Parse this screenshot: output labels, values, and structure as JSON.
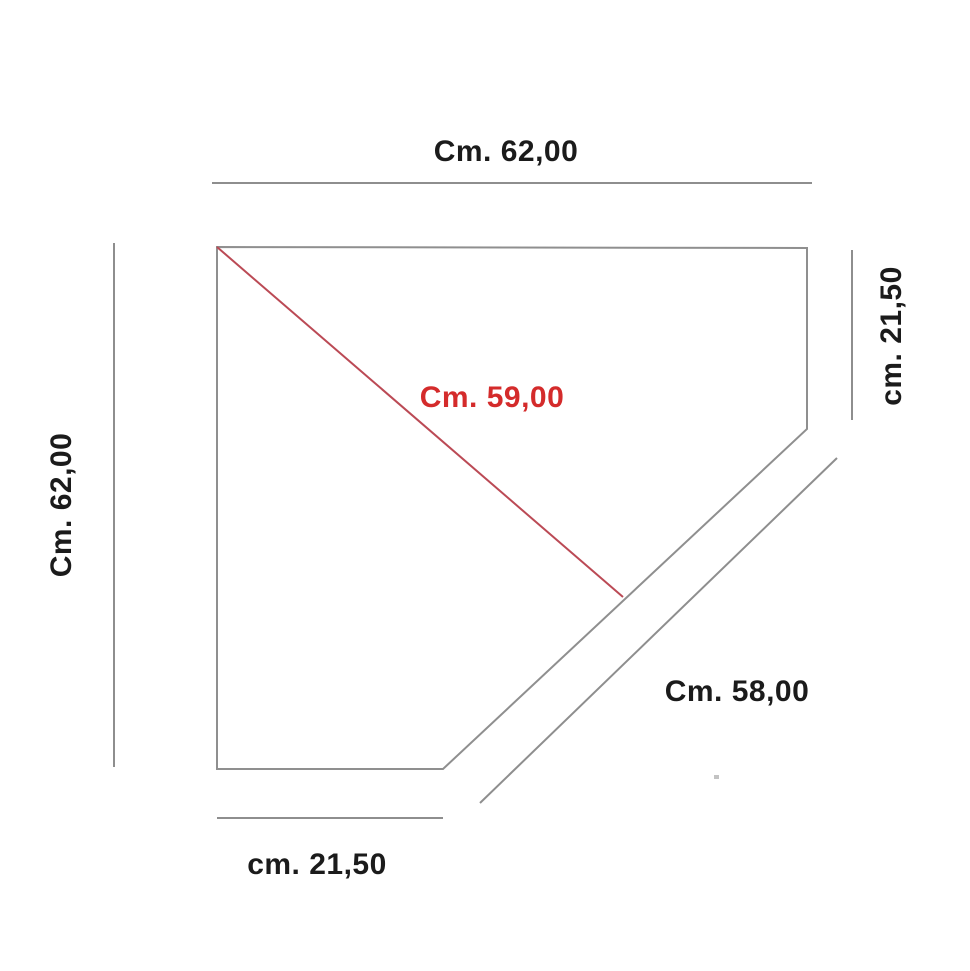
{
  "diagram": {
    "unit": "cm",
    "colors": {
      "background": "#ffffff",
      "outline": "#8f8f8f",
      "dimension_line": "#8e8e8e",
      "text": "#1b1b1b",
      "red_text": "#d42b2b",
      "red_line": "#bb4a55"
    },
    "shape": {
      "type": "pentagon-corner-panel",
      "edges": [
        "top",
        "right",
        "diagonal-cut",
        "bottom",
        "left"
      ]
    },
    "measurements": {
      "top_width": {
        "label": "Cm. 62,00",
        "value": 62.0,
        "side": "top"
      },
      "left_height": {
        "label": "Cm. 62,00",
        "value": 62.0,
        "side": "left"
      },
      "right_side": {
        "label": "cm. 21,50",
        "value": 21.5,
        "side": "right"
      },
      "bottom_side": {
        "label": "cm. 21,50",
        "value": 21.5,
        "side": "bottom"
      },
      "diagonal_cut": {
        "label": "Cm. 58,00",
        "value": 58.0,
        "side": "diagonal-cut"
      },
      "inner_diagonal": {
        "label": "Cm. 59,00",
        "value": 59.0,
        "side": "inner-diagonal",
        "color": "#d42b2b"
      }
    }
  }
}
